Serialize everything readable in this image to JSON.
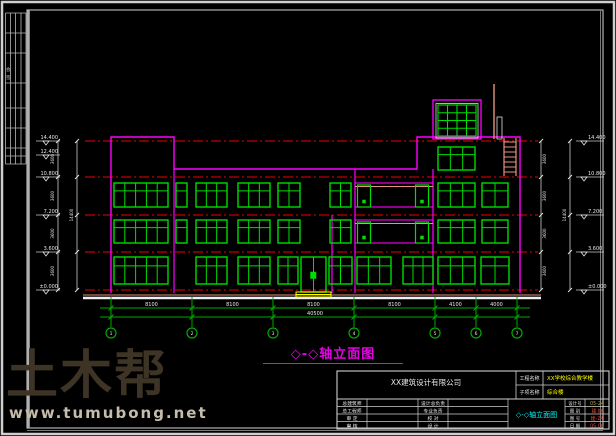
{
  "colors": {
    "background": "#000000",
    "frame_outer": "#cfcfcf",
    "frame_inner": "#b0b0b0",
    "grid_gray": "#b8b8b8",
    "level_red": "#c00000",
    "outline_magenta": "#ff00ff",
    "window_green": "#00dd00",
    "dim_green": "#00aa00",
    "accent_salmon": "#e8927f",
    "steps_yellow": "#ffff00",
    "text_white": "#e8e8e8",
    "ground_white": "#f0f0f0",
    "title_cyan": "#00ffff",
    "value_yellow": "#ffff00",
    "stamp_red": "#d94f3d",
    "code_olive": "#b8a642",
    "watermark_brown": "#3e3425",
    "watermark_url": "#c6bcab",
    "caption_magenta": "#e800e8"
  },
  "sign_strip": {
    "labels": [
      {
        "text": "会",
        "x": 6,
        "y": 71
      },
      {
        "text": "签",
        "x": 6,
        "y": 79
      }
    ]
  },
  "watermark": {
    "brand": "土木帮",
    "url": "www.tumubong.net"
  },
  "caption": {
    "text": "◇-◇轴立面图"
  },
  "elevation": {
    "levels": [
      {
        "y": 141,
        "value": "14.400"
      },
      {
        "y": 177,
        "value": "10.800"
      },
      {
        "y": 215,
        "value": "7.200"
      },
      {
        "y": 252,
        "value": "3.600"
      },
      {
        "y": 290,
        "value": "±0.000"
      }
    ],
    "extra_left_level": {
      "y": 155,
      "value": "12.400"
    },
    "floor_dim": "3600",
    "total_height_dim": "14400",
    "axes": [
      {
        "x": 111,
        "label": "1"
      },
      {
        "x": 192,
        "label": "2"
      },
      {
        "x": 273,
        "label": "3"
      },
      {
        "x": 354,
        "label": "4"
      },
      {
        "x": 435,
        "label": "5"
      },
      {
        "x": 476,
        "label": "6"
      },
      {
        "x": 517,
        "label": "7"
      }
    ],
    "bay_dims": [
      "8100",
      "8100",
      "8100",
      "8100",
      "4100",
      "4000"
    ],
    "total_width_dim": "40500",
    "window_rows": [
      {
        "name": "floor-4",
        "y": 147,
        "h": 23,
        "banks": [
          {
            "x": 438,
            "w": 37,
            "panes": 3
          }
        ]
      },
      {
        "name": "floor-3",
        "y": 183,
        "h": 24,
        "banks": [
          {
            "x": 114,
            "w": 54,
            "panes": 5
          },
          {
            "x": 176,
            "w": 11,
            "panes": 1
          },
          {
            "x": 196,
            "w": 31,
            "panes": 3
          },
          {
            "x": 238,
            "w": 32,
            "panes": 3
          },
          {
            "x": 278,
            "w": 22,
            "panes": 2
          },
          {
            "x": 330,
            "w": 21,
            "panes": 2
          },
          {
            "x": 438,
            "w": 37,
            "panes": 3
          },
          {
            "x": 482,
            "w": 26,
            "panes": 2
          }
        ]
      },
      {
        "name": "floor-2",
        "y": 220,
        "h": 23,
        "banks": [
          {
            "x": 114,
            "w": 54,
            "panes": 5
          },
          {
            "x": 176,
            "w": 11,
            "panes": 1
          },
          {
            "x": 196,
            "w": 31,
            "panes": 3
          },
          {
            "x": 238,
            "w": 32,
            "panes": 3
          },
          {
            "x": 278,
            "w": 22,
            "panes": 2
          },
          {
            "x": 330,
            "w": 21,
            "panes": 2
          },
          {
            "x": 438,
            "w": 37,
            "panes": 3
          },
          {
            "x": 482,
            "w": 26,
            "panes": 2
          }
        ]
      },
      {
        "name": "floor-1",
        "y": 257,
        "h": 27,
        "banks": [
          {
            "x": 114,
            "w": 54,
            "panes": 5
          },
          {
            "x": 196,
            "w": 31,
            "panes": 3
          },
          {
            "x": 238,
            "w": 32,
            "panes": 3
          },
          {
            "x": 278,
            "w": 20,
            "panes": 2
          },
          {
            "x": 329,
            "w": 23,
            "panes": 2
          },
          {
            "x": 357,
            "w": 34,
            "panes": 3
          },
          {
            "x": 403,
            "w": 30,
            "panes": 3
          },
          {
            "x": 438,
            "w": 37,
            "panes": 3
          },
          {
            "x": 481,
            "w": 28,
            "panes": 2
          }
        ]
      }
    ],
    "corridors": [
      {
        "y": 183,
        "h": 24
      },
      {
        "y": 220,
        "h": 23
      }
    ]
  },
  "title_block": {
    "company": "XX建筑设计有限公司",
    "project_rows": [
      {
        "label": "工程名称",
        "value": "XX学校综合教学楼"
      },
      {
        "label": "子项名称",
        "value": "综合楼"
      }
    ],
    "sign_rows": [
      {
        "a": "总建筑师",
        "c": "设计总负责"
      },
      {
        "a": "总工程师",
        "c": "专业负责"
      },
      {
        "a": "审 定",
        "c": "校 对"
      },
      {
        "a": "审 核",
        "c": "设 计"
      }
    ],
    "drawing_title": "◇-◇轴立面图",
    "info_rows": [
      {
        "label": "设计号",
        "value": "05-24",
        "color": "olive"
      },
      {
        "label": "图 别",
        "value": "建 施",
        "color": "red"
      },
      {
        "label": "图 号",
        "value": "建-24",
        "color": "red"
      },
      {
        "label": "日 期",
        "value": "05.06",
        "color": "red"
      }
    ]
  }
}
